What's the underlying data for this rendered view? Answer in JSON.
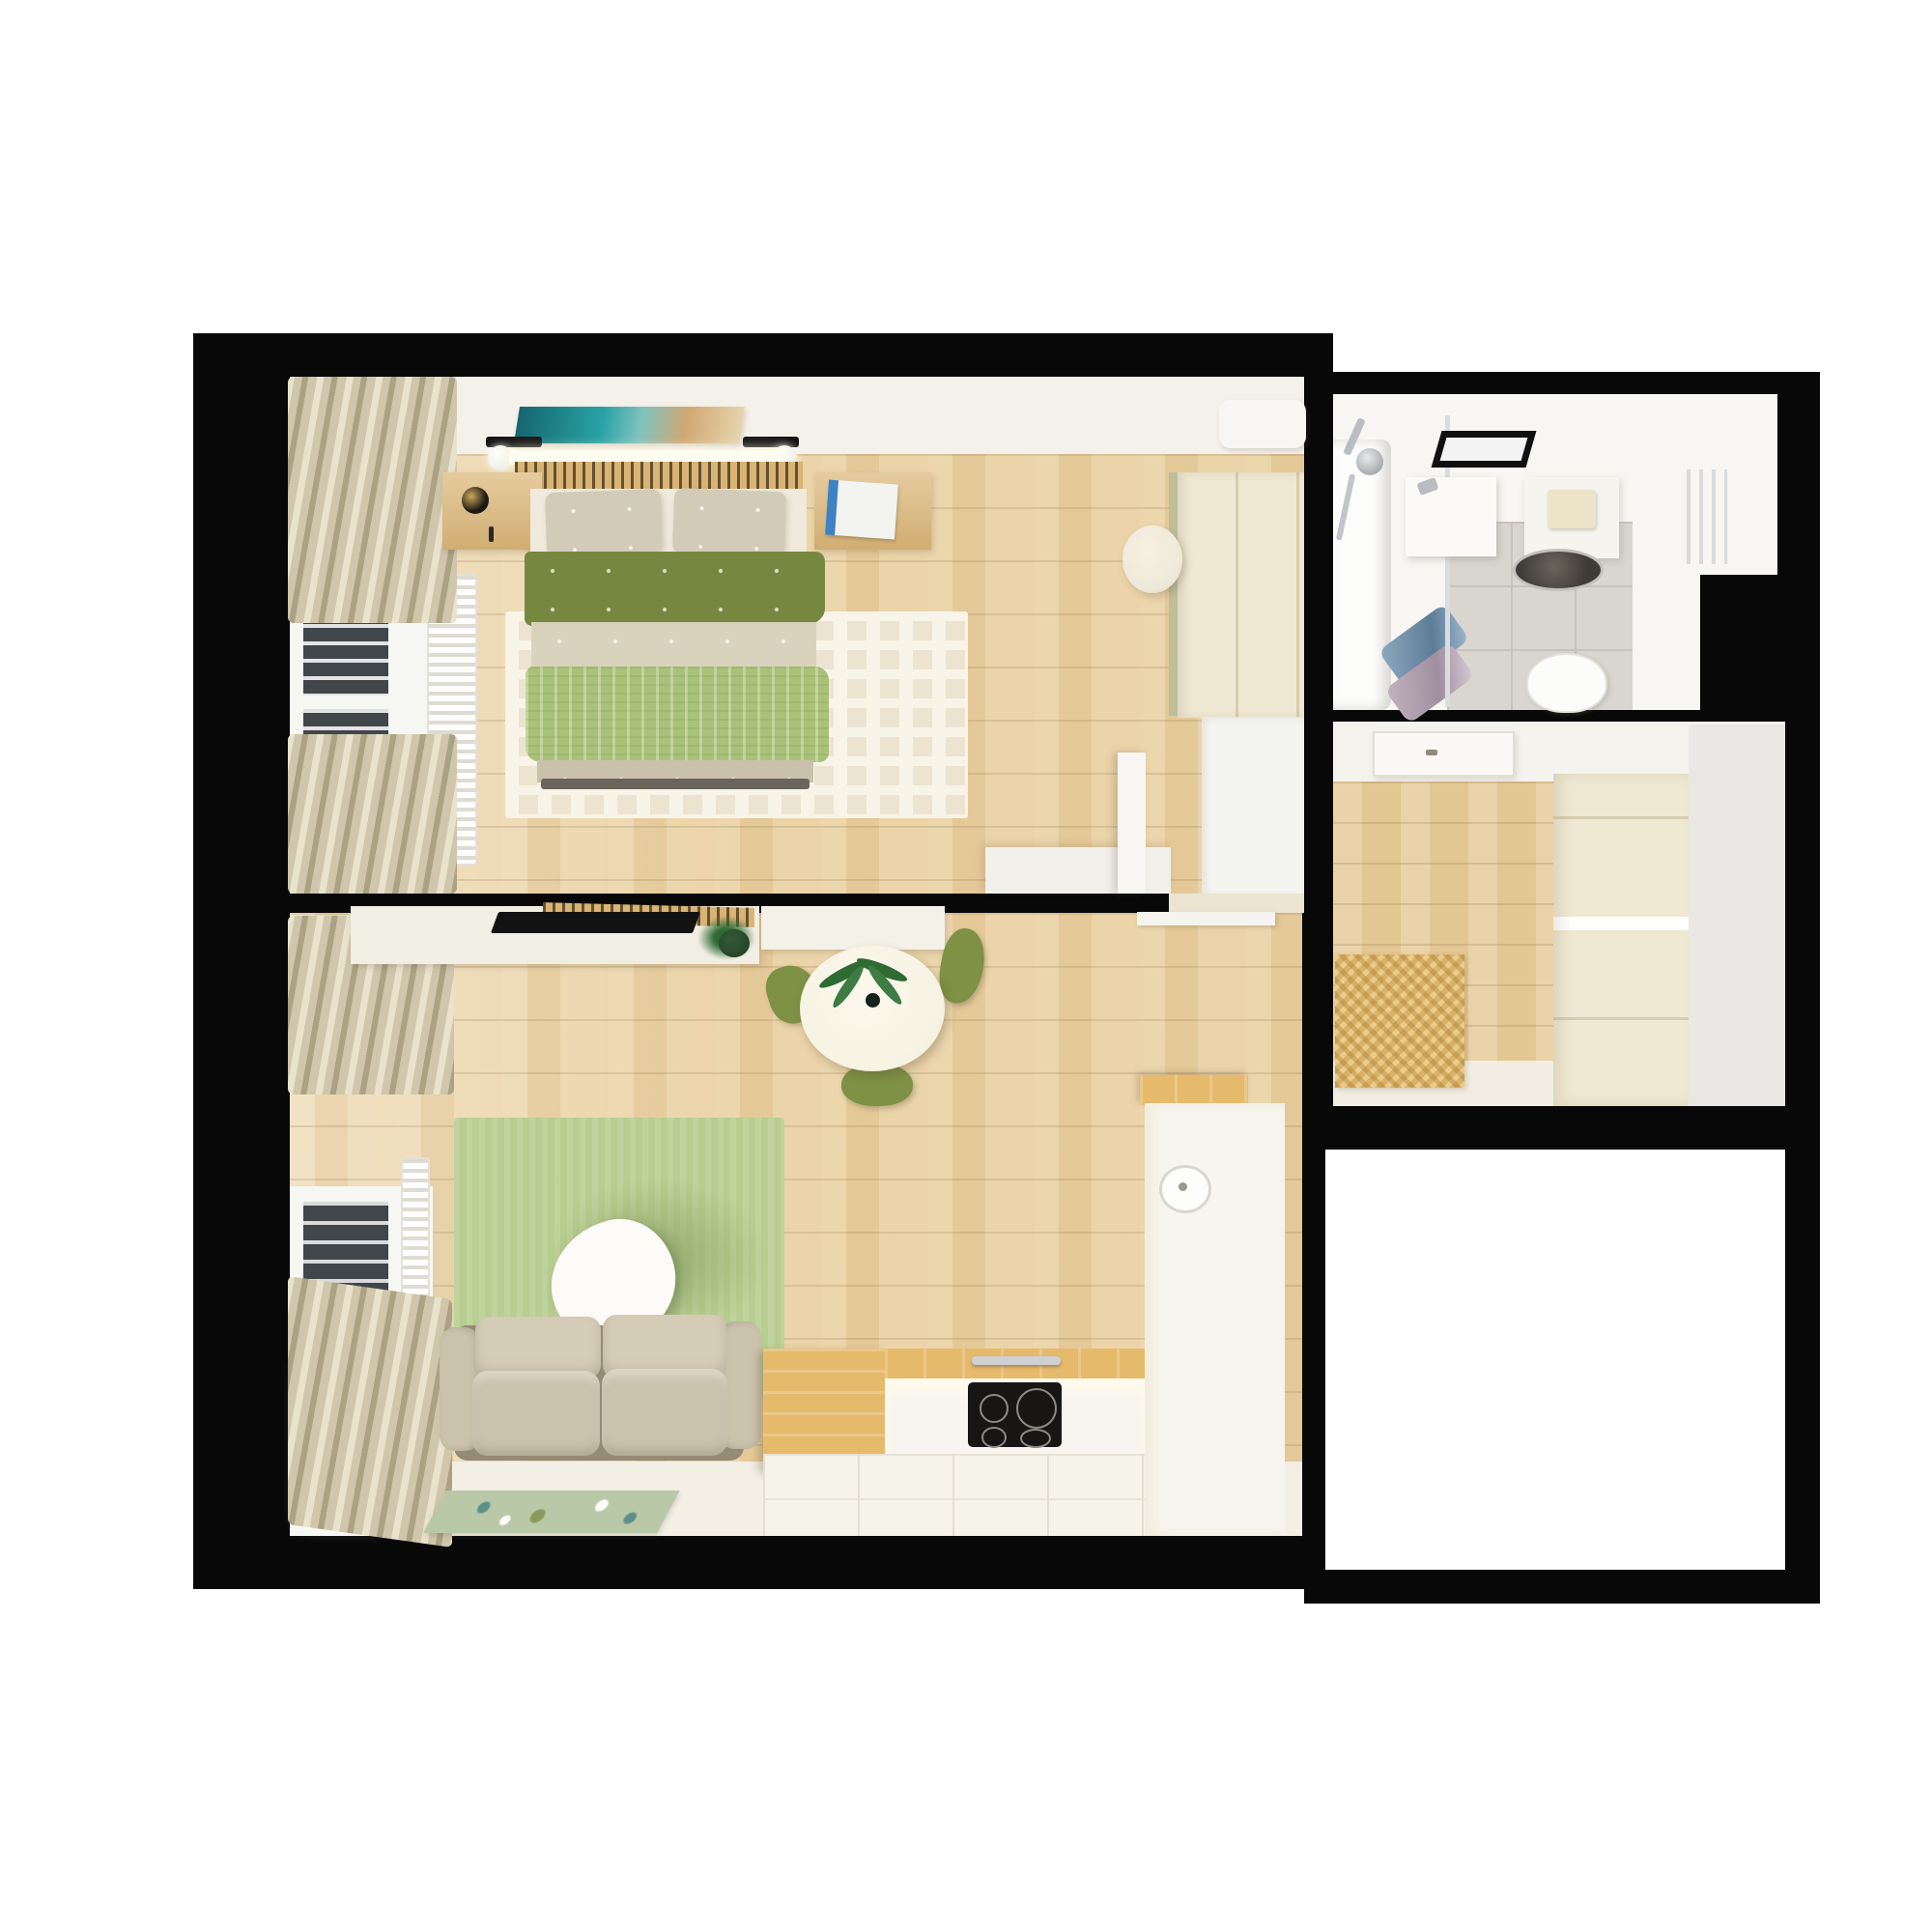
{
  "title": "apartment-floor-plan-3d-top-view",
  "description": "Top-down 3D render of a one-bedroom apartment floor plan with black walls on a white page; no visible text labels in the image",
  "palette": {
    "page": "#ffffff",
    "wall": "#080808",
    "wood": "#e9cf9f",
    "wood2": "#e6cb98",
    "wallband": "#f4f1ea",
    "curtain": "#cfc6ab",
    "curtainLight": "#e9e2cd",
    "curtainDark": "#aba183",
    "radFin": "#dedbd2",
    "slatWood": "#d9b475",
    "slatDark": "#63512f",
    "glassDark": "#41464b",
    "glassBright": "#ffffff",
    "ledBar": "#fffdf0",
    "artTeal": "#2aa3a6",
    "artTealDeep": "#14666e",
    "artSand": "#cfa873",
    "nightstand": "#ddba7e",
    "sheet": "#efeadc",
    "pillow": "#d2cbb7",
    "duvetGreen": "#76883f",
    "quiltBeige": "#d9d3be",
    "throwGreen": "#a9c178",
    "footboard": "#c9c1ab",
    "bedFrameDark": "#6a655c",
    "rugBedroom": "#ece4d1",
    "rugPattern": "#f8f4e8",
    "wardrobeCream": "#efe8d3",
    "wardrobeSeam": "#d8cdb0",
    "wardrobeWhite": "#f4f4f1",
    "greenEdge": "#bcbf98",
    "pouf": "#eee8d8",
    "white": "#f7f6f2",
    "console": "#f1eee3",
    "tv": "#121212",
    "tableWhite": "#f7f3e3",
    "chairGreen": "#7e9144",
    "palmGreen": "#2e6b33",
    "plantDark": "#1e3d22",
    "rugLiving": "#b8cd90",
    "rugLivingShadow": "#94ac6d",
    "coffeeTable": "#fcfbf7",
    "laptop": "#2e3237",
    "sofa": "#ccc3ad",
    "sofaCushion": "#d6cdb8",
    "sofaBase": "#948b76",
    "matLiving": "#b9c9a8",
    "counterWood": "#e5ba6b",
    "counterWhite": "#f7f5ef",
    "cooktop": "#171614",
    "cooktopRing": "#8d8a83",
    "chrome": "#cfd0d2",
    "kitchenFloor": "#f6f3ea",
    "bottomBand": "#f3efe5",
    "bathBase": "#f7f6f2",
    "bathTile": "#d9d6d0",
    "bathGrout": "#c6c3bb",
    "tub": "#fdfdfc",
    "towelBlue": "#8fa9bf",
    "towelPink": "#c3b3bd",
    "mirrorBlack": "#101010",
    "basinDark": "#3f3c37",
    "tissue": "#ece3c8",
    "matHall": "#d9b269",
    "hallWallStrip": "#e9e8e4",
    "doorWhite": "#f9f8f4",
    "floorStrip": "#f1ede2"
  },
  "rooms": [
    {
      "id": "bedroom",
      "label": "Bedroom",
      "furniture": [
        "double-bed",
        "slatted-headboard",
        "wall-artwork",
        "wall-lamps",
        "nightstand-left-with-lamp",
        "nightstand-right-with-magazine",
        "area-rug",
        "window-with-blinds",
        "curtains",
        "radiator",
        "wardrobe",
        "low-dresser",
        "pouf",
        "air-conditioner",
        "open-door"
      ]
    },
    {
      "id": "living-room",
      "label": "Living room with kitchen",
      "furniture": [
        "tv-console",
        "wall-tv",
        "slatted-tv-panel",
        "potted-plant",
        "sideboard",
        "round-dining-table",
        "palm-centerpiece",
        "dining-chairs-green",
        "green-rug",
        "organic-coffee-table",
        "laptop",
        "two-seat-sofa",
        "floor-mat",
        "window",
        "curtains",
        "radiator",
        "kitchen-peninsula",
        "induction-cooktop",
        "oven-handle",
        "kitchen-counter-run",
        "kitchen-sink",
        "white-tile-floor"
      ]
    },
    {
      "id": "bathroom",
      "label": "Bathroom",
      "furniture": [
        "bathtub",
        "shower-set",
        "glass-screen",
        "towels",
        "black-framed-mirror",
        "vanity-sink",
        "cistern-shelf-with-tissue",
        "countertop-basin",
        "toilet",
        "towel-radiator",
        "grey-floor-tiles"
      ]
    },
    {
      "id": "hallway",
      "label": "Entrance hallway",
      "furniture": [
        "entrance-door",
        "herringbone-doormat",
        "built-in-wardrobe",
        "wood-floor"
      ]
    },
    {
      "id": "empty-room",
      "label": "Unfurnished white room",
      "furniture": []
    }
  ]
}
